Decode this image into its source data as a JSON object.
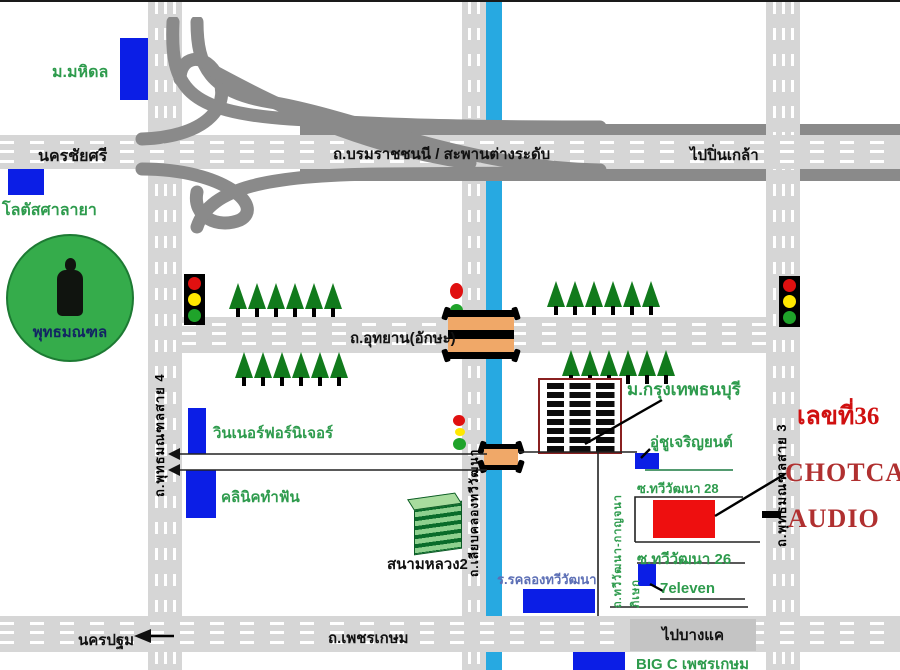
{
  "map": {
    "title_labels": {
      "mahidol_university": "ม.มหิดล",
      "nakhon_chai_si": "นครชัยศรี",
      "lotus_salaya": "โลตัสศาลายา",
      "phutthamonthon_park": "พุทธมณฑล",
      "borommaratchachonnani_road": "ถ.บรมราชชนนี   /   สะพานต่างระดับ",
      "to_pin_klao": "ไปปิ่นเกล้า",
      "utthayan_aksa_road": "ถ.อุทยาน(อักษะ)",
      "phutthamonthon_sai4_road": "ถ.พุทธมณฑลสาย 4",
      "phutthamonthon_sai3_road": "ถ.พุทธมณฑลสาย 3",
      "liab_khlong_thawi_watthana_road": "ถ.เลียบคลองทวีวัฒนา",
      "winner_furniture": "วินเนอร์ฟอร์นิเจอร์",
      "dental_clinic": "คลินิคทำฟัน",
      "sanam_luang_2": "สนามหลวง2",
      "bangkok_thonburi_university": "ม.กรุงเทพธนบุรี",
      "garage_chu_charoen_yon": "อู่ชูเจริญยนต์",
      "soi_thawi_watthana_28": "ซ.ทวีวัฒนา 28",
      "soi_thawi_watthana_26": "ซ.ทวีวัฒนา 26",
      "seven_eleven": "7eleven",
      "khlong_thawi_watthana_school": "ร.รคลองทวีวัฒนา",
      "thawi_watthana_kanchanaphisek_road": "ถ.ทวีวัฒนา-กาญจนาภิเษก",
      "phetkasem_road": "ถ.เพชรเกษม",
      "nakhon_pathom": "นครปฐม",
      "to_bang_khae": "ไปบางแค",
      "big_c_phetkasem": "BIG C เพชรเกษม",
      "address_number": "เลขที่36",
      "shop_name_line1": "CHOTCAR",
      "shop_name_line2": "AUDIO"
    },
    "colors": {
      "road_gray": "#d6d6d6",
      "overpass_dark_gray": "#8a8a8a",
      "canal_blue": "#27a9e1",
      "landmark_blue": "#0b1ee6",
      "label_green": "#2e9b4d",
      "shop_red_box": "#ee0f0f",
      "shop_text_red": "#b03030",
      "bridge_orange": "#f0a868",
      "park_green": "#35ac4b"
    },
    "tree_rows": [
      {
        "x": 228,
        "y": 281,
        "count": 6
      },
      {
        "x": 234,
        "y": 350,
        "count": 6
      },
      {
        "x": 546,
        "y": 279,
        "count": 6
      },
      {
        "x": 561,
        "y": 348,
        "count": 6
      }
    ]
  }
}
